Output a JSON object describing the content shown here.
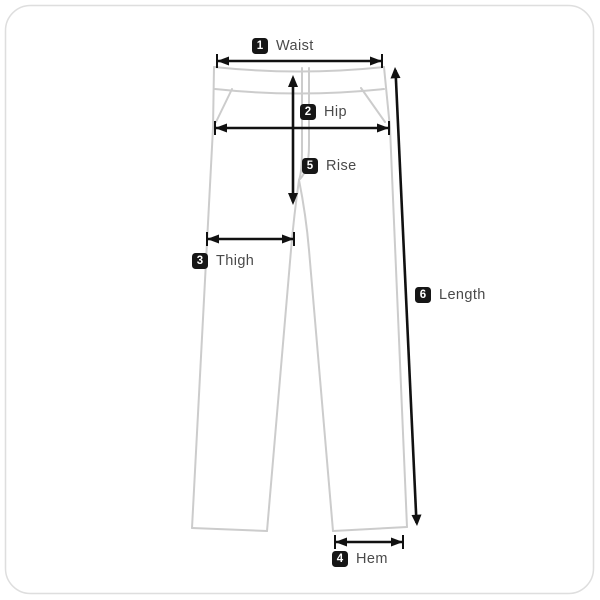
{
  "diagram": {
    "subject": "pants-size-measurement-guide",
    "measurements": [
      {
        "id": "waist",
        "number": "1",
        "label": "Waist"
      },
      {
        "id": "hip",
        "number": "2",
        "label": "Hip"
      },
      {
        "id": "thigh",
        "number": "3",
        "label": "Thigh"
      },
      {
        "id": "hem",
        "number": "4",
        "label": "Hem"
      },
      {
        "id": "rise",
        "number": "5",
        "label": "Rise"
      },
      {
        "id": "length",
        "number": "6",
        "label": "Length"
      }
    ]
  },
  "colors": {
    "background": "#ffffff",
    "card_border": "#dedede",
    "garment_outline": "#cccccc",
    "measure_line": "#111111",
    "badge_background": "#161616",
    "badge_number": "#ffffff",
    "label_text": "#4a4a4a"
  }
}
